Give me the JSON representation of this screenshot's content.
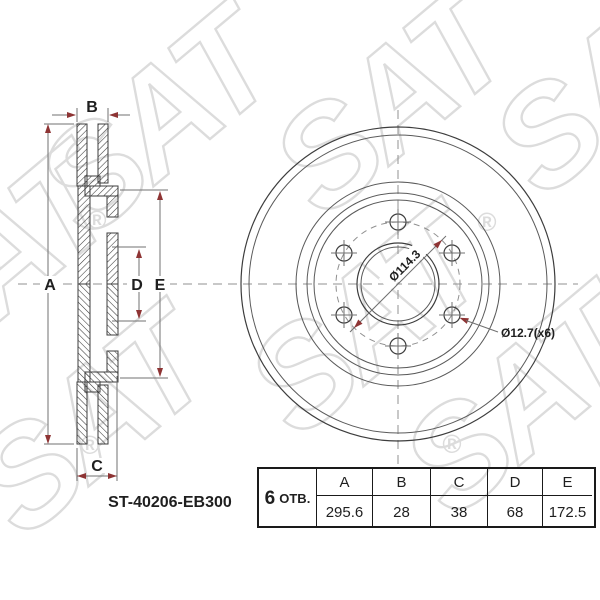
{
  "part_number": "ST-40206-EB300",
  "section": {
    "a": "A",
    "b": "B",
    "c": "C",
    "d": "D",
    "e": "E"
  },
  "front": {
    "bolt_circle_dia": "Ø114.3",
    "bolt_hole_dia": "Ø12.7(x6)"
  },
  "table": {
    "holes_count": "6",
    "holes_label": "ОТВ.",
    "columns": [
      "A",
      "B",
      "C",
      "D",
      "E"
    ],
    "values": [
      "295.6",
      "28",
      "38",
      "68",
      "172.5"
    ]
  },
  "watermark": {
    "text": "SAT",
    "reg": "®"
  },
  "colors": {
    "line": "#3d3d3d",
    "thin": "#5a5a5a",
    "dim": "#707070",
    "centerline": "#909090",
    "arrow": "#8e3434",
    "watermark": "#dcdcdc",
    "text": "#1f1f1f"
  }
}
